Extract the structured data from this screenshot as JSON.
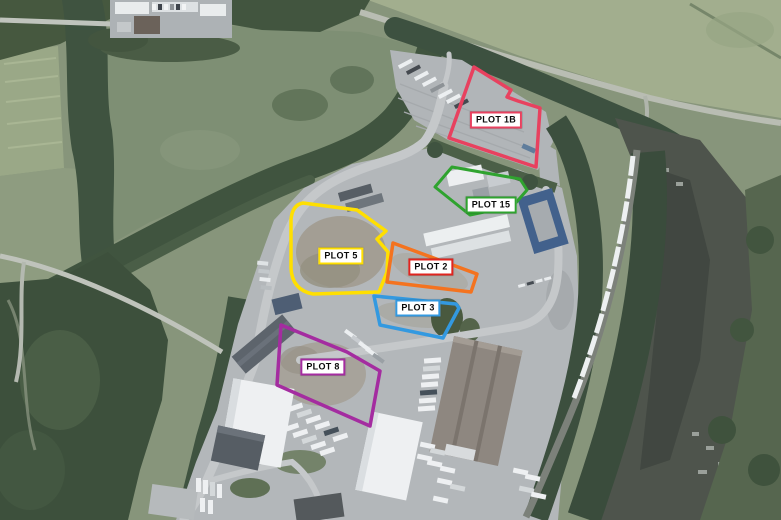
{
  "map": {
    "plots": [
      {
        "id": "plot-1b",
        "label": "PLOT 1B",
        "outline_color": "#e8415f",
        "label_border_color": "#e8415f"
      },
      {
        "id": "plot-15",
        "label": "PLOT 15",
        "outline_color": "#2fa32f",
        "label_border_color": "#2fa32f"
      },
      {
        "id": "plot-5",
        "label": "PLOT 5",
        "outline_color": "#ffdf00",
        "label_border_color": "#ffdf00"
      },
      {
        "id": "plot-2",
        "label": "PLOT 2",
        "outline_color": "#f4731f",
        "label_border_color": "#e0251f"
      },
      {
        "id": "plot-3",
        "label": "PLOT 3",
        "outline_color": "#3399e0",
        "label_border_color": "#3399e0"
      },
      {
        "id": "plot-8",
        "label": "PLOT 8",
        "outline_color": "#a42ca0",
        "label_border_color": "#a42ca0"
      }
    ]
  }
}
